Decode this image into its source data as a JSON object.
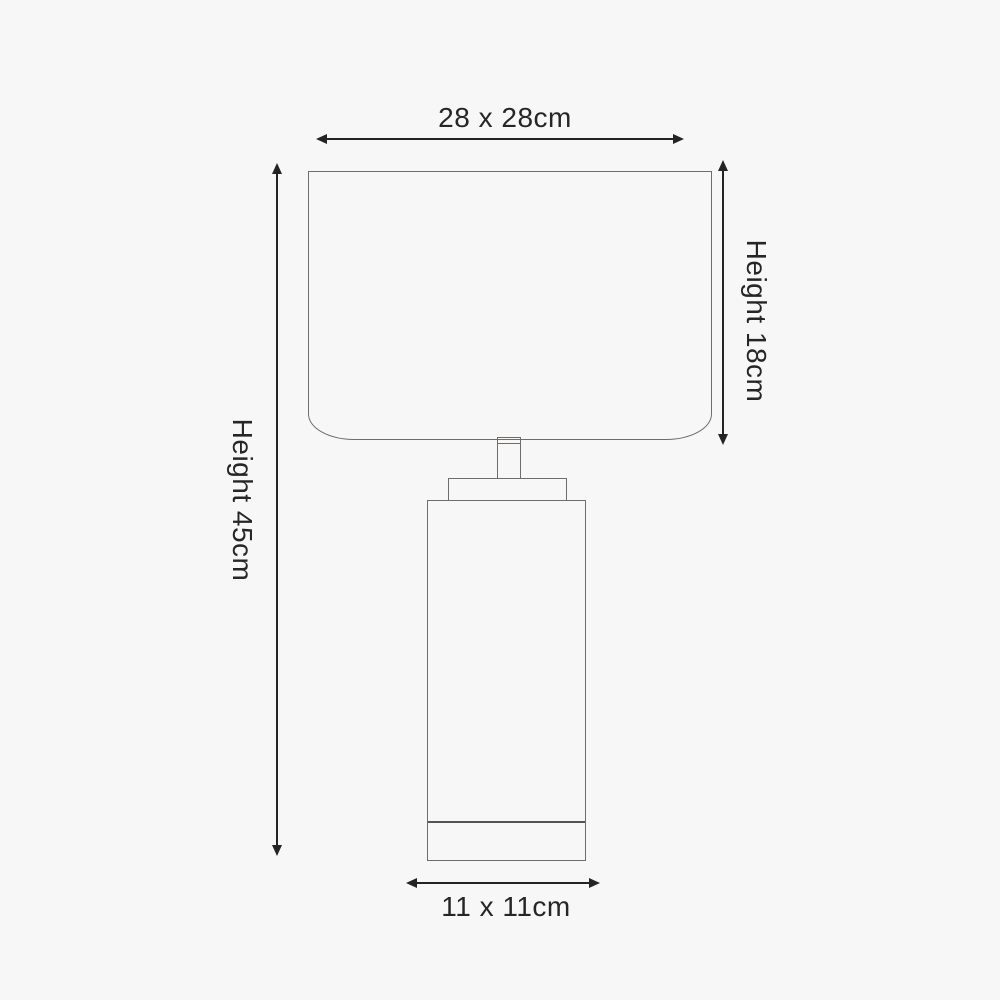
{
  "colors": {
    "background": "#f7f7f7",
    "lamp_outline": "#6f6c69",
    "dimension_lines": "#242424",
    "dimension_text": "#262626"
  },
  "lamp": {
    "parts": [
      "shade",
      "neck",
      "cap",
      "body",
      "base-band"
    ]
  },
  "dimensions": {
    "shade_width_label": "28 x 28cm",
    "shade_height_label": "Height 18cm",
    "overall_height_label": "Height 45cm",
    "base_width_label": "11 x 11cm"
  }
}
